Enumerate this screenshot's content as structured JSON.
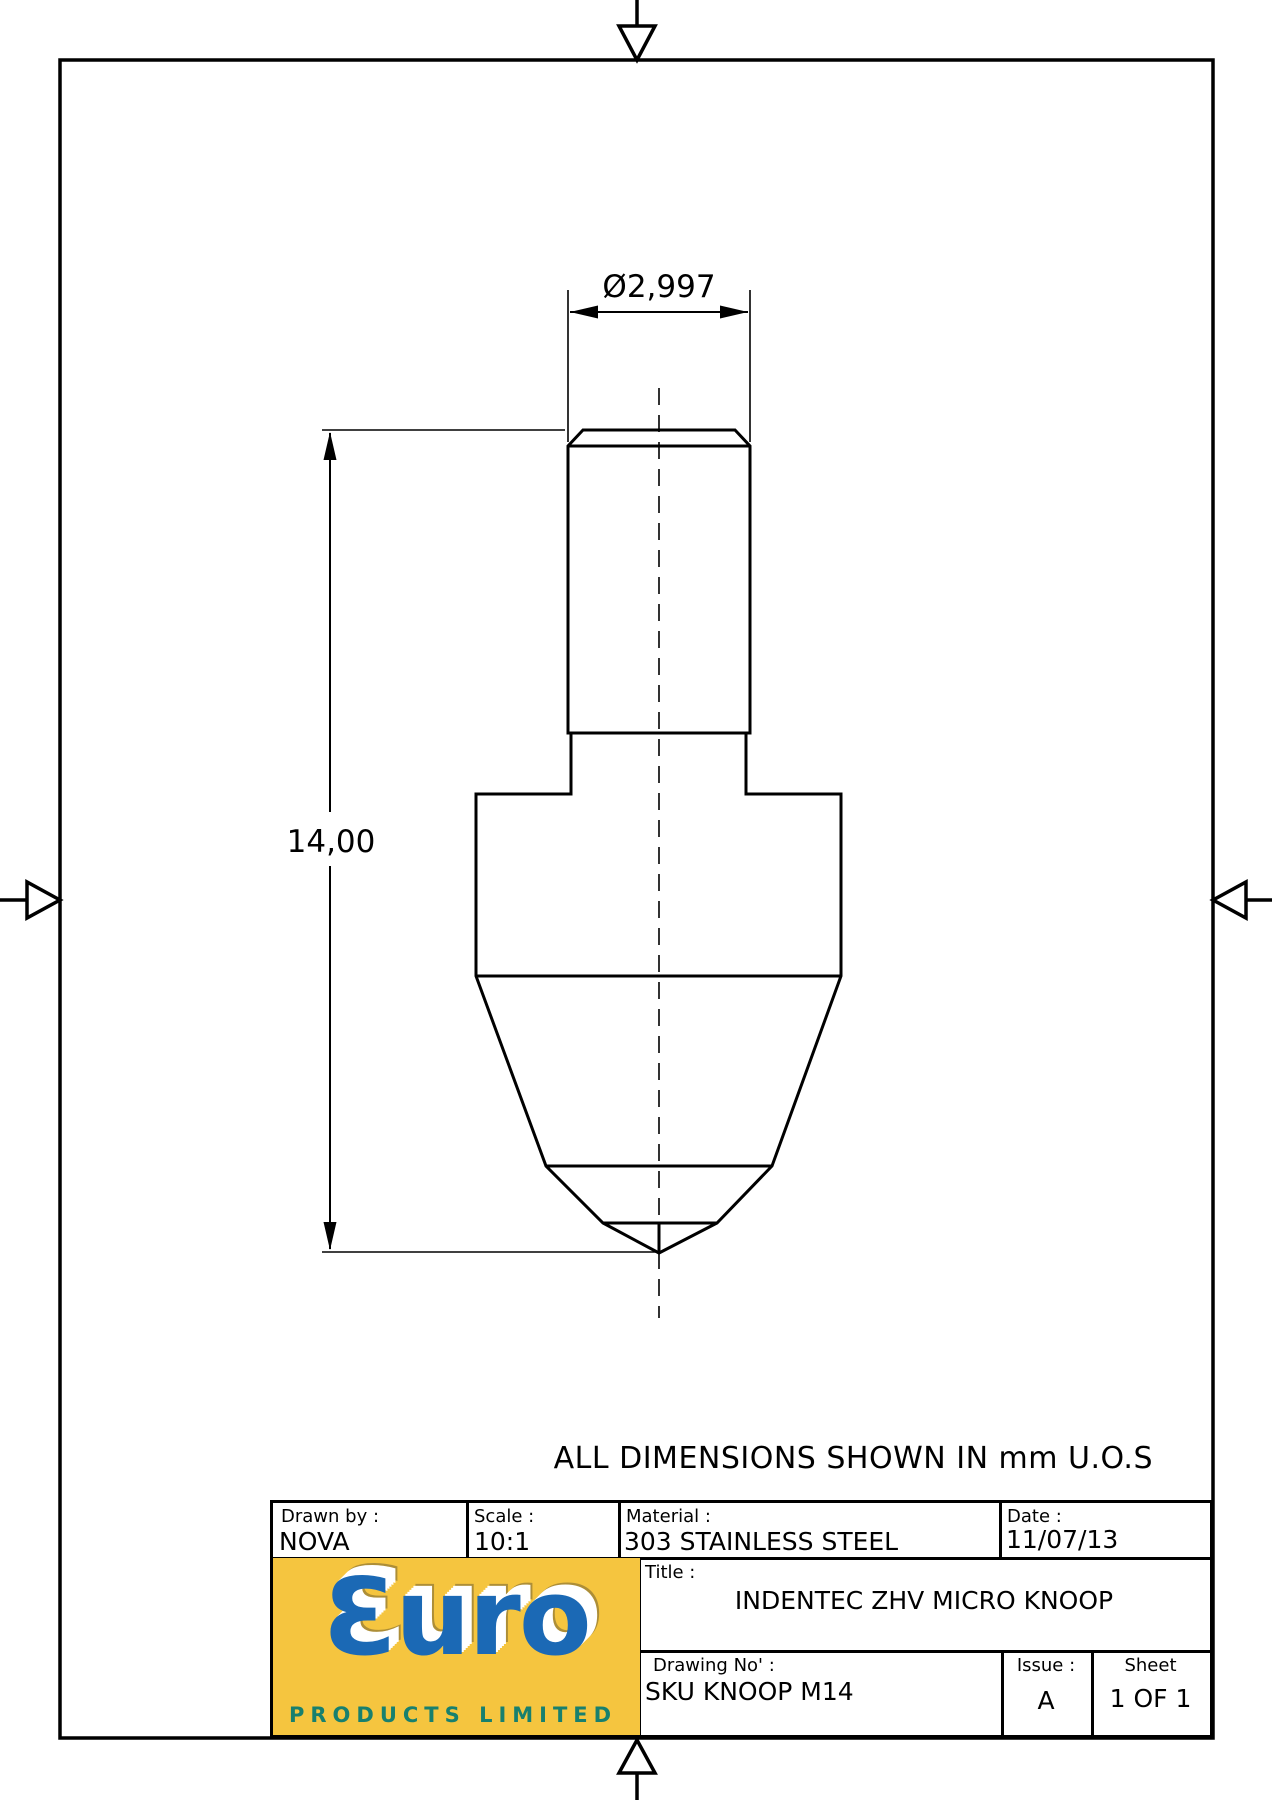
{
  "note": "ALL DIMENSIONS SHOWN IN mm U.O.S",
  "drawing": {
    "dim_diameter": "Ø2,997",
    "dim_height": "14,00"
  },
  "title_block": {
    "drawn_by": {
      "label": "Drawn by :",
      "value": "NOVA"
    },
    "scale": {
      "label": "Scale :",
      "value": "10:1"
    },
    "material": {
      "label": "Material :",
      "value": "303 STAINLESS STEEL"
    },
    "date": {
      "label": "Date :",
      "value": "11/07/13"
    },
    "title": {
      "label": "Title :",
      "value": "INDENTEC ZHV MICRO KNOOP"
    },
    "drawing_no": {
      "label": "Drawing No' :",
      "value": "SKU KNOOP M14"
    },
    "issue": {
      "label": "Issue :",
      "value": "A"
    },
    "sheet": {
      "label": "Sheet",
      "value": "1 OF 1"
    }
  },
  "logo": {
    "brand": "Ɛuro",
    "subtext": "PRODUCTS LIMITED",
    "colors": {
      "background": "#F5C53F",
      "letters": "#1B69B5",
      "subtext": "#18806E"
    }
  }
}
